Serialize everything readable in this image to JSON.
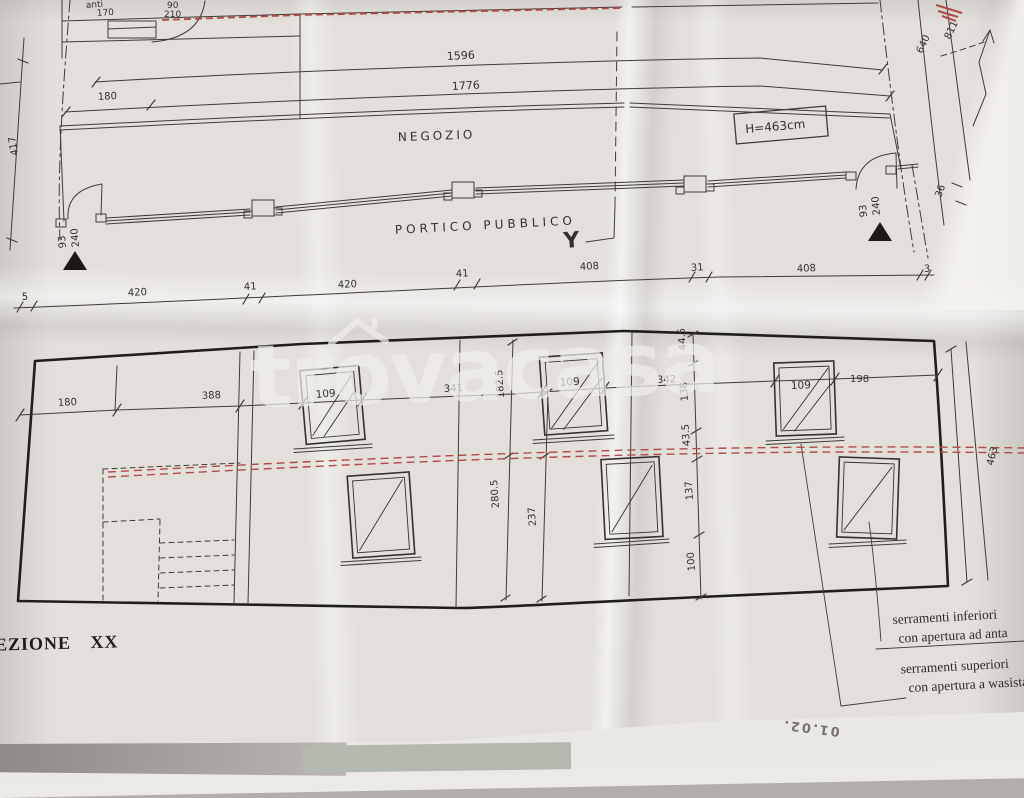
{
  "plan": {
    "labels": {
      "room": "anti",
      "area": "NEGOZIO",
      "portico": "PORTICO PUBBLICO",
      "height_box": "H=463cm",
      "section_marker": "Y"
    },
    "dims": {
      "top_small": [
        "170",
        "90",
        "210"
      ],
      "overall": [
        "1596",
        "1776"
      ],
      "left_width": "180",
      "left_height": "417",
      "right": [
        "640",
        "811",
        "36"
      ],
      "door_left": [
        "93",
        "240"
      ],
      "door_right": [
        "93",
        "240"
      ],
      "bottom": [
        "5",
        "420",
        "41",
        "420",
        "41",
        "408",
        "31",
        "408",
        "3"
      ]
    }
  },
  "section": {
    "title": "EZIONE XX",
    "window_label": "109",
    "dims": {
      "horizontal": [
        "180",
        "388",
        "341",
        "342",
        "198"
      ],
      "vertical_left": [
        "182.5",
        "280.5",
        "237"
      ],
      "vertical_mid": [
        "44.5",
        "138",
        "43.5",
        "137",
        "100"
      ],
      "right_height": "463"
    },
    "notes": {
      "lower_line1": "serramenti inferiori",
      "lower_line2": "con apertura ad anta",
      "upper_line1": "serramenti superiori",
      "upper_line2": "con apertura a wasistas"
    }
  },
  "watermark": {
    "part1": "tr",
    "part2": "o",
    "part3": "vacasa"
  },
  "stamp": "01.02.",
  "colors": {
    "paper": "#e3e0dc",
    "ink": "#3f3c38",
    "ink_heavy": "#1f1e1c",
    "red": "#b04a48",
    "watermark": "#f0eeea"
  }
}
